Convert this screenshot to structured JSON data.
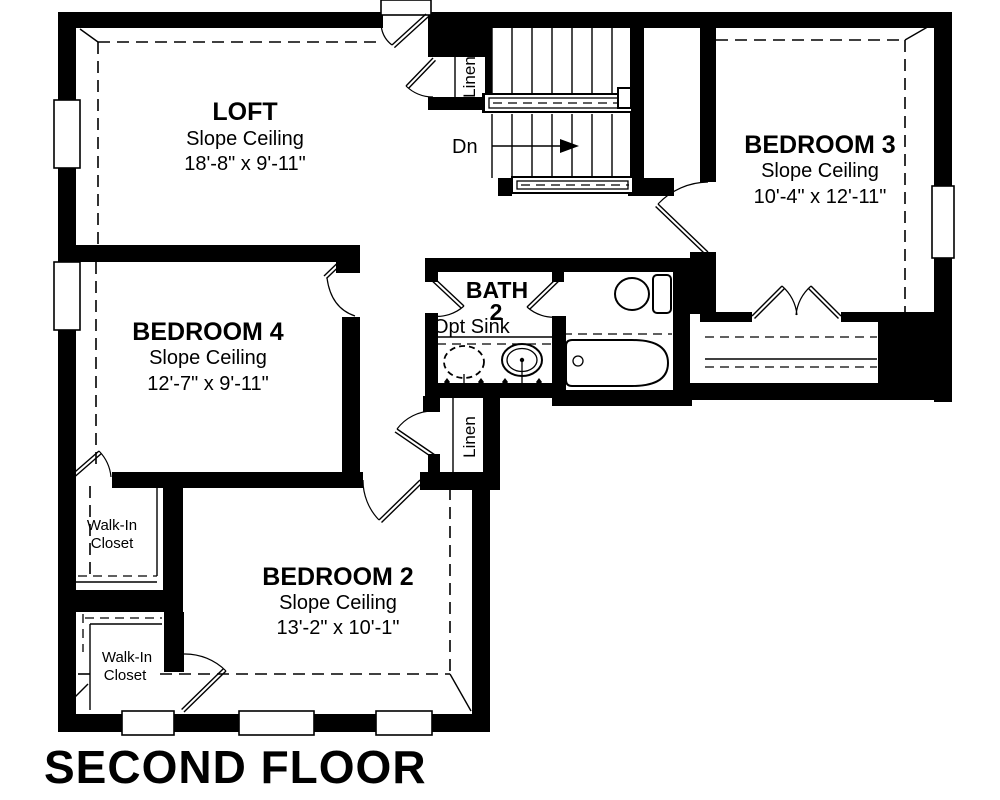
{
  "page": {
    "floor_title": "SECOND FLOOR"
  },
  "plan": {
    "rooms": {
      "loft": {
        "name": "LOFT",
        "ceiling": "Slope Ceiling",
        "dims": "18'-8\" x 9'-11\""
      },
      "bedroom3": {
        "name": "BEDROOM 3",
        "ceiling": "Slope Ceiling",
        "dims": "10'-4\" x 12'-11\""
      },
      "bedroom4": {
        "name": "BEDROOM 4",
        "ceiling": "Slope Ceiling",
        "dims": "12'-7\" x 9'-11\""
      },
      "bedroom2": {
        "name": "BEDROOM 2",
        "ceiling": "Slope Ceiling",
        "dims": "13'-2\" x 10'-1\""
      },
      "bath2": {
        "name": "BATH",
        "number": "2",
        "option_label": "Opt Sink"
      },
      "walk_in_closet_upper": {
        "line1": "Walk-In",
        "line2": "Closet"
      },
      "walk_in_closet_lower": {
        "line1": "Walk-In",
        "line2": "Closet"
      },
      "linen_upper": {
        "label": "Linen"
      },
      "linen_lower": {
        "label": "Linen"
      }
    },
    "stairs": {
      "down_label": "Dn"
    }
  },
  "colors": {
    "walls": "#000000",
    "background": "#ffffff",
    "text": "#000000"
  }
}
